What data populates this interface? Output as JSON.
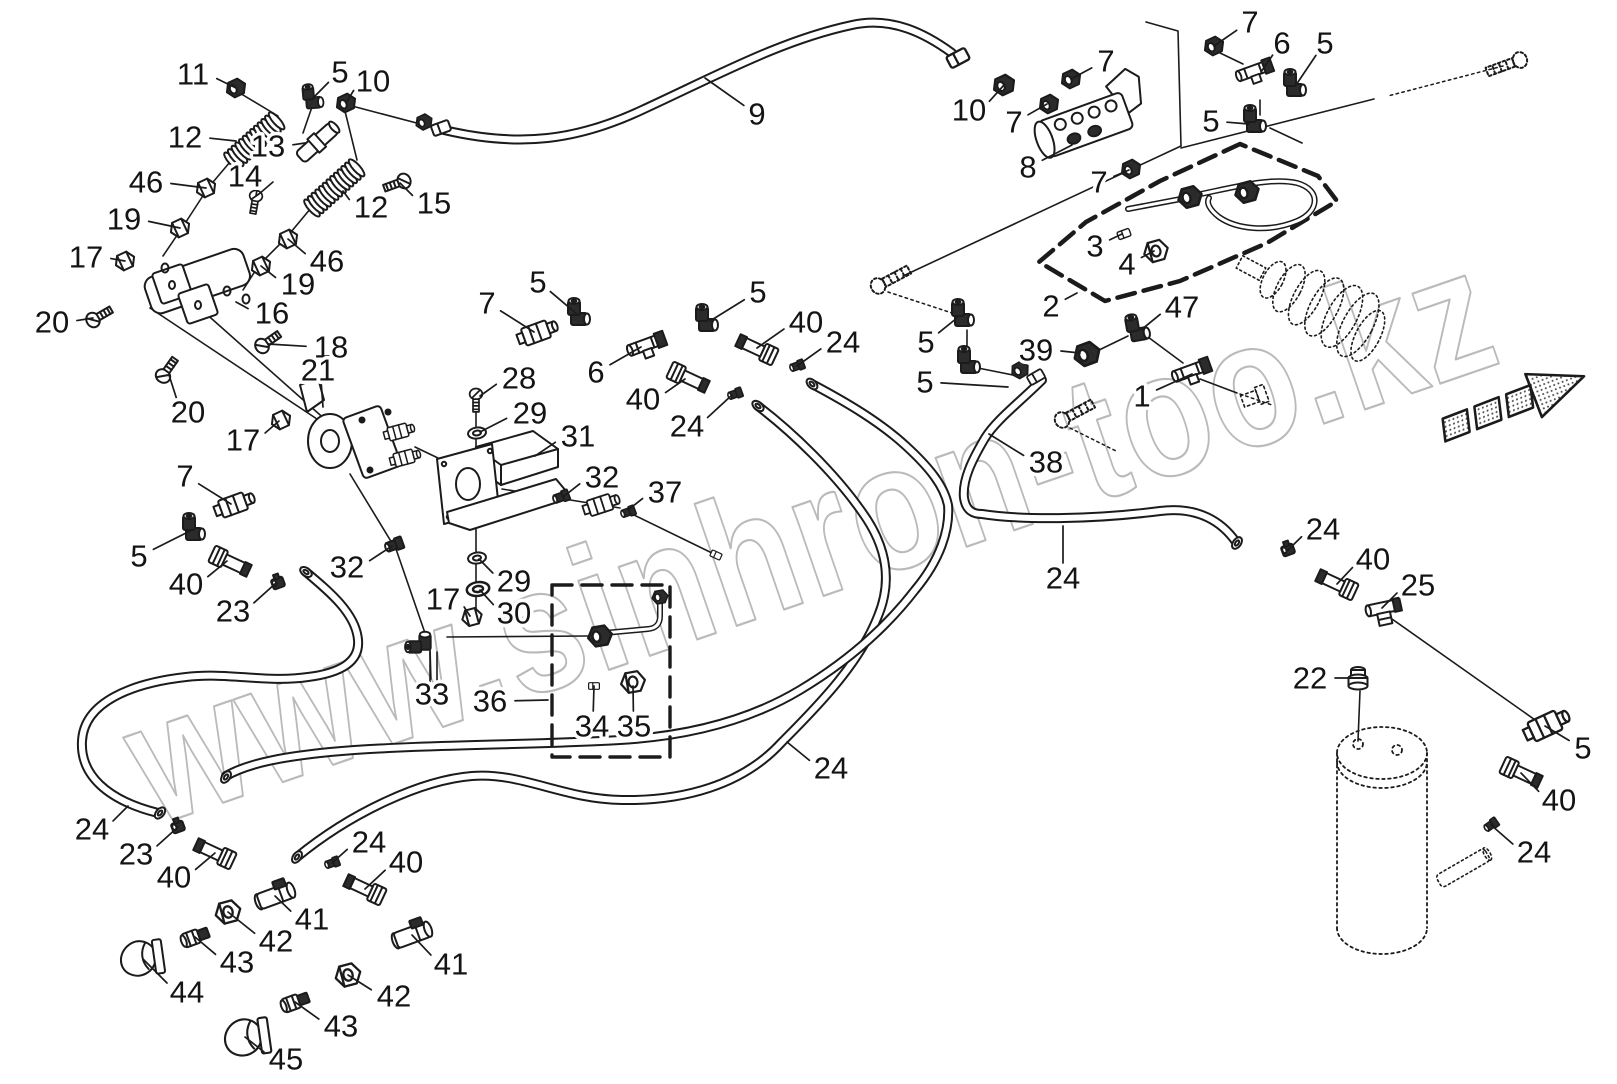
{
  "figure": {
    "width": 1617,
    "height": 1084,
    "background": "#ffffff",
    "ink": "#1b1b1b",
    "type": "exploded-parts-diagram"
  },
  "watermark": {
    "text": "www.sinhron-too.kz",
    "color": "#a9a9a9",
    "opacity": 0.8,
    "rotation_deg": -19
  },
  "callouts": [
    {
      "t": "11",
      "x": 193,
      "y": 74,
      "tx": 236,
      "ty": 88
    },
    {
      "t": "5",
      "x": 340,
      "y": 72,
      "tx": 313,
      "ty": 98
    },
    {
      "t": "10",
      "x": 373,
      "y": 81,
      "tx": 346,
      "ty": 103
    },
    {
      "t": "12",
      "x": 185,
      "y": 137,
      "tx": 236,
      "ty": 141
    },
    {
      "t": "13",
      "x": 268,
      "y": 146,
      "tx": 305,
      "ty": 143
    },
    {
      "t": "14",
      "x": 245,
      "y": 176,
      "tx": 256,
      "ty": 196
    },
    {
      "t": "46",
      "x": 146,
      "y": 182,
      "tx": 206,
      "ty": 188
    },
    {
      "t": "12",
      "x": 371,
      "y": 207,
      "tx": 343,
      "ty": 191
    },
    {
      "t": "15",
      "x": 434,
      "y": 203,
      "tx": 400,
      "ty": 183
    },
    {
      "t": "19",
      "x": 124,
      "y": 219,
      "tx": 180,
      "ty": 228
    },
    {
      "t": "17",
      "x": 86,
      "y": 257,
      "tx": 125,
      "ty": 261
    },
    {
      "t": "46",
      "x": 327,
      "y": 261,
      "tx": 288,
      "ty": 239
    },
    {
      "t": "19",
      "x": 298,
      "y": 284,
      "tx": 261,
      "ty": 266
    },
    {
      "t": "16",
      "x": 272,
      "y": 313,
      "tx": 236,
      "ty": 302
    },
    {
      "t": "18",
      "x": 331,
      "y": 347,
      "tx": 268,
      "ty": 344
    },
    {
      "t": "20",
      "x": 52,
      "y": 322,
      "tx": 93,
      "ty": 318
    },
    {
      "t": "20",
      "x": 188,
      "y": 412,
      "tx": 169,
      "ty": 375
    },
    {
      "t": "21",
      "x": 318,
      "y": 370,
      "tx": 323,
      "ty": 407
    },
    {
      "t": "17",
      "x": 243,
      "y": 440,
      "tx": 279,
      "ty": 421
    },
    {
      "t": "7",
      "x": 185,
      "y": 476,
      "tx": 231,
      "ty": 504
    },
    {
      "t": "5",
      "x": 139,
      "y": 556,
      "tx": 192,
      "ty": 530
    },
    {
      "t": "40",
      "x": 186,
      "y": 584,
      "tx": 227,
      "ty": 561
    },
    {
      "t": "23",
      "x": 233,
      "y": 611,
      "tx": 276,
      "ty": 583
    },
    {
      "t": "32",
      "x": 347,
      "y": 567,
      "tx": 392,
      "ty": 546
    },
    {
      "t": "28",
      "x": 519,
      "y": 378,
      "tx": 480,
      "ty": 396
    },
    {
      "t": "29",
      "x": 530,
      "y": 413,
      "tx": 480,
      "ty": 432
    },
    {
      "t": "31",
      "x": 578,
      "y": 436,
      "tx": 535,
      "ty": 456
    },
    {
      "t": "32",
      "x": 602,
      "y": 477,
      "tx": 563,
      "ty": 497
    },
    {
      "t": "37",
      "x": 665,
      "y": 492,
      "tx": 628,
      "ty": 510
    },
    {
      "t": "5",
      "x": 538,
      "y": 282,
      "tx": 578,
      "ty": 315
    },
    {
      "t": "7",
      "x": 487,
      "y": 303,
      "tx": 534,
      "ty": 332
    },
    {
      "t": "6",
      "x": 596,
      "y": 372,
      "tx": 641,
      "ty": 347
    },
    {
      "t": "5",
      "x": 758,
      "y": 292,
      "tx": 710,
      "ty": 321
    },
    {
      "t": "40",
      "x": 643,
      "y": 399,
      "tx": 685,
      "ty": 379
    },
    {
      "t": "24",
      "x": 687,
      "y": 426,
      "tx": 732,
      "ty": 395
    },
    {
      "t": "40",
      "x": 806,
      "y": 322,
      "tx": 757,
      "ty": 348
    },
    {
      "t": "24",
      "x": 843,
      "y": 342,
      "tx": 797,
      "ty": 366
    },
    {
      "t": "29",
      "x": 514,
      "y": 581,
      "tx": 479,
      "ty": 559
    },
    {
      "t": "30",
      "x": 514,
      "y": 613,
      "tx": 480,
      "ty": 590
    },
    {
      "t": "17",
      "x": 443,
      "y": 599,
      "tx": 470,
      "ty": 616
    },
    {
      "t": "33",
      "x": 432,
      "y": 694,
      "tx": 430,
      "ty": 650
    },
    {
      "t": "36",
      "x": 490,
      "y": 701,
      "tx": 548,
      "ty": 700
    },
    {
      "t": "34",
      "x": 592,
      "y": 726,
      "tx": 594,
      "ty": 686
    },
    {
      "t": "35",
      "x": 634,
      "y": 726,
      "tx": 633,
      "ty": 686
    },
    {
      "t": "24",
      "x": 831,
      "y": 768,
      "tx": 787,
      "ty": 742
    },
    {
      "t": "9",
      "x": 757,
      "y": 114,
      "tx": 705,
      "ty": 78
    },
    {
      "t": "10",
      "x": 969,
      "y": 110,
      "tx": 1004,
      "ty": 85
    },
    {
      "t": "7",
      "x": 1106,
      "y": 61,
      "tx": 1071,
      "ty": 79
    },
    {
      "t": "7",
      "x": 1014,
      "y": 122,
      "tx": 1047,
      "ty": 104
    },
    {
      "t": "8",
      "x": 1028,
      "y": 167,
      "tx": 1072,
      "ty": 145
    },
    {
      "t": "7",
      "x": 1099,
      "y": 182,
      "tx": 1129,
      "ty": 170
    },
    {
      "t": "3",
      "x": 1095,
      "y": 246,
      "tx": 1122,
      "ty": 234
    },
    {
      "t": "4",
      "x": 1127,
      "y": 264,
      "tx": 1154,
      "ty": 251
    },
    {
      "t": "2",
      "x": 1051,
      "y": 306,
      "tx": 1077,
      "ty": 293
    },
    {
      "t": "47",
      "x": 1182,
      "y": 307,
      "tx": 1141,
      "ty": 330
    },
    {
      "t": "39",
      "x": 1036,
      "y": 350,
      "tx": 1080,
      "ty": 353
    },
    {
      "t": "5",
      "x": 926,
      "y": 342,
      "tx": 957,
      "ty": 318
    },
    {
      "t": "5",
      "x": 925,
      "y": 382,
      "tx": 1008,
      "ty": 387
    },
    {
      "t": "1",
      "x": 1142,
      "y": 396,
      "tx": 1192,
      "ty": 374
    },
    {
      "t": "38",
      "x": 1046,
      "y": 462,
      "tx": 989,
      "ty": 434
    },
    {
      "t": "24",
      "x": 1063,
      "y": 578,
      "tx": 1063,
      "ty": 526
    },
    {
      "t": "24",
      "x": 1323,
      "y": 529,
      "tx": 1288,
      "ty": 550
    },
    {
      "t": "40",
      "x": 1373,
      "y": 559,
      "tx": 1337,
      "ty": 584
    },
    {
      "t": "25",
      "x": 1418,
      "y": 585,
      "tx": 1382,
      "ty": 608
    },
    {
      "t": "22",
      "x": 1310,
      "y": 678,
      "tx": 1356,
      "ty": 678
    },
    {
      "t": "5",
      "x": 1583,
      "y": 748,
      "tx": 1545,
      "ty": 726
    },
    {
      "t": "40",
      "x": 1559,
      "y": 800,
      "tx": 1521,
      "ty": 773
    },
    {
      "t": "24",
      "x": 1534,
      "y": 852,
      "tx": 1491,
      "ty": 825
    },
    {
      "t": "24",
      "x": 92,
      "y": 829,
      "tx": 128,
      "ty": 806
    },
    {
      "t": "23",
      "x": 136,
      "y": 854,
      "tx": 178,
      "ty": 827
    },
    {
      "t": "40",
      "x": 174,
      "y": 877,
      "tx": 215,
      "ty": 853
    },
    {
      "t": "24",
      "x": 369,
      "y": 842,
      "tx": 332,
      "ty": 863
    },
    {
      "t": "40",
      "x": 406,
      "y": 862,
      "tx": 365,
      "ty": 889
    },
    {
      "t": "41",
      "x": 312,
      "y": 919,
      "tx": 275,
      "ty": 896
    },
    {
      "t": "42",
      "x": 276,
      "y": 941,
      "tx": 228,
      "ty": 912
    },
    {
      "t": "43",
      "x": 237,
      "y": 962,
      "tx": 195,
      "ty": 937
    },
    {
      "t": "44",
      "x": 187,
      "y": 992,
      "tx": 143,
      "ty": 959
    },
    {
      "t": "41",
      "x": 451,
      "y": 964,
      "tx": 412,
      "ty": 935
    },
    {
      "t": "42",
      "x": 394,
      "y": 996,
      "tx": 348,
      "ty": 975
    },
    {
      "t": "43",
      "x": 341,
      "y": 1026,
      "tx": 295,
      "ty": 1002
    },
    {
      "t": "45",
      "x": 286,
      "y": 1059,
      "tx": 245,
      "ty": 1037
    },
    {
      "t": "7",
      "x": 1250,
      "y": 22,
      "tx": 1214,
      "ty": 46
    },
    {
      "t": "6",
      "x": 1282,
      "y": 43,
      "tx": 1261,
      "ty": 72
    },
    {
      "t": "5",
      "x": 1325,
      "y": 43,
      "tx": 1296,
      "ty": 85
    },
    {
      "t": "5",
      "x": 1211,
      "y": 121,
      "tx": 1249,
      "ty": 124
    }
  ]
}
